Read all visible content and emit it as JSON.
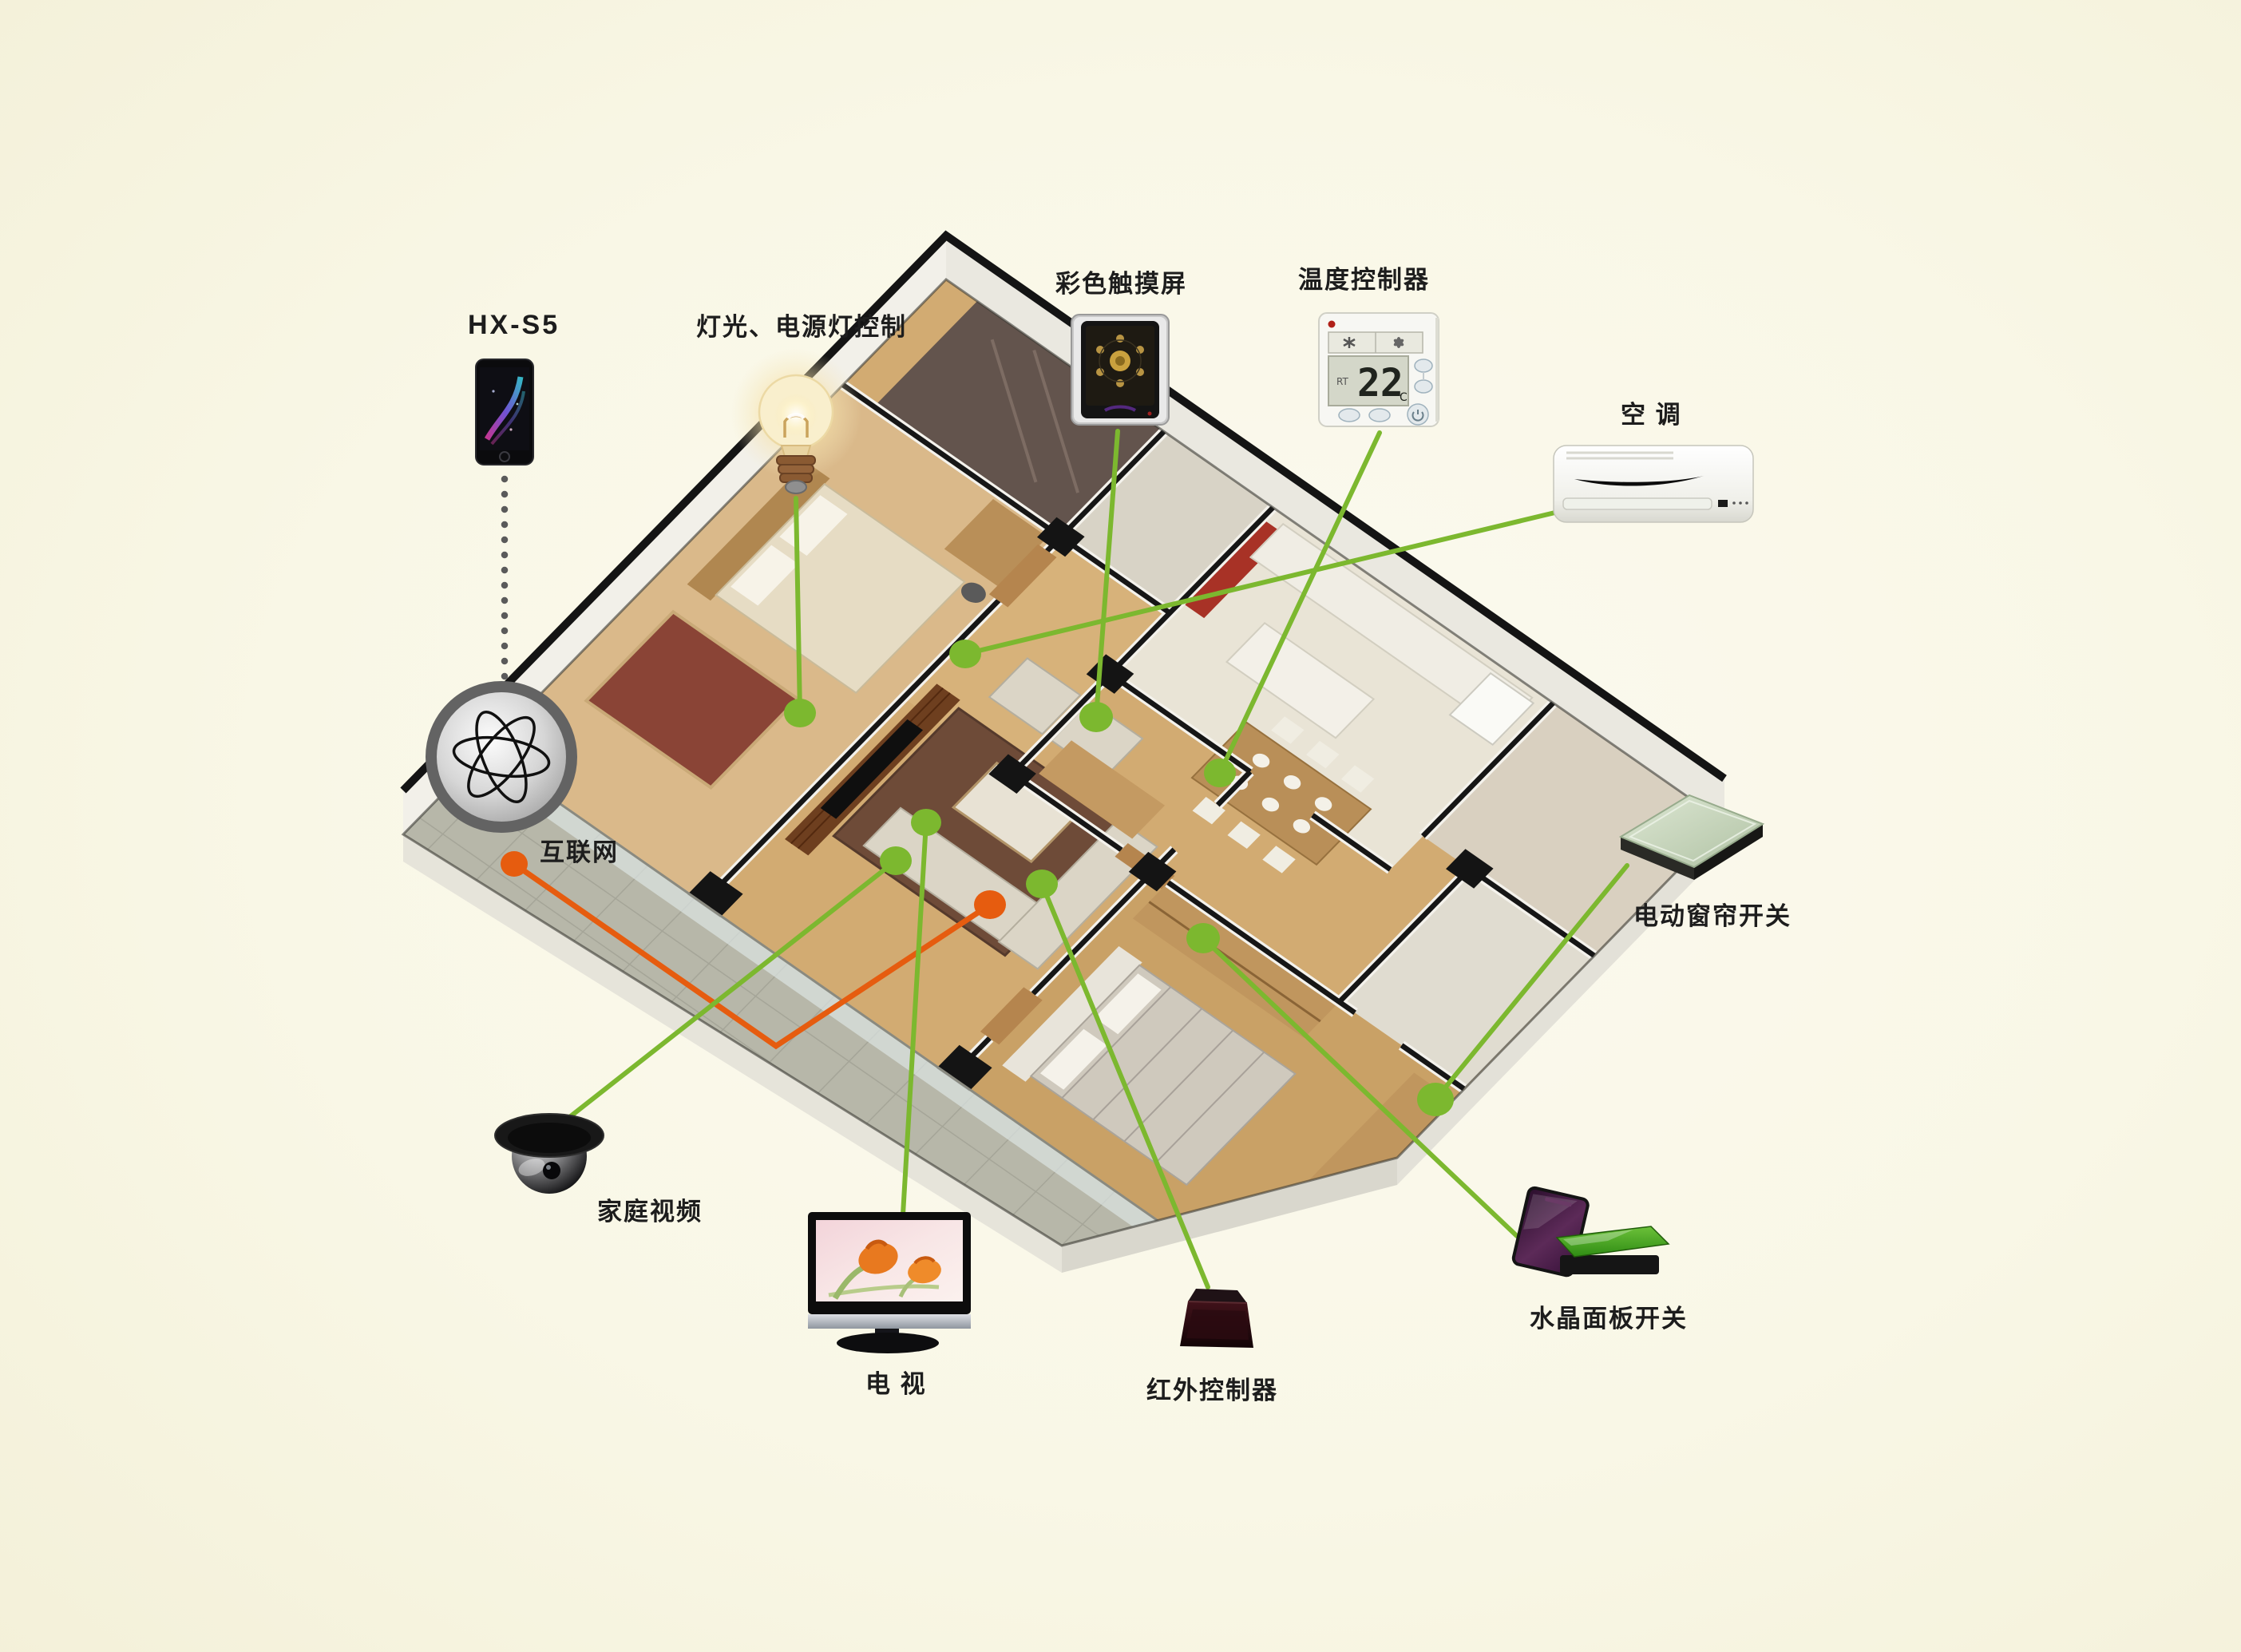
{
  "page": {
    "type": "smart-home-system-diagram",
    "background_color": "#f9f7e6"
  },
  "colors": {
    "line_green": "#7cb82f",
    "line_orange": "#e65c0f",
    "dot_green": "#7cb82f",
    "dot_orange": "#e65c0f",
    "label_text": "#1d1d1d",
    "dotted_link_gray": "#5a5a5a"
  },
  "labels": {
    "phone": "HX-S5",
    "light": "灯光、电源灯控制",
    "touchscreen": "彩色触摸屏",
    "thermostat": "温度控制器",
    "ac": "空 调",
    "internet": "互联网",
    "camera": "家庭视频",
    "tv": "电 视",
    "ir": "红外控制器",
    "crystal": "水晶面板开关",
    "curtain": "电动窗帘开关"
  },
  "devices": {
    "thermostat": {
      "temp": "22",
      "unit": "°C",
      "mode_label": "RT"
    }
  },
  "connections": [
    {
      "from": "phone",
      "to": "internet",
      "style": "dotted-gray"
    },
    {
      "from": "internet",
      "to": "living-room",
      "style": "orange-elbow"
    },
    {
      "from": "light-control",
      "to": "bedroom-1",
      "style": "green"
    },
    {
      "from": "color-touchscreen",
      "to": "entry-hall",
      "style": "green"
    },
    {
      "from": "temperature-controller",
      "to": "dining-area",
      "style": "green"
    },
    {
      "from": "air-conditioner",
      "to": "hallway",
      "style": "green"
    },
    {
      "from": "home-video-camera",
      "to": "living-room-wall",
      "style": "green"
    },
    {
      "from": "tv",
      "to": "media-wall",
      "style": "green"
    },
    {
      "from": "infrared-controller",
      "to": "living-room",
      "style": "green"
    },
    {
      "from": "crystal-panel-switch",
      "to": "bedroom-2",
      "style": "green"
    },
    {
      "from": "curtain-switch",
      "to": "bedroom-2-window",
      "style": "green"
    }
  ]
}
